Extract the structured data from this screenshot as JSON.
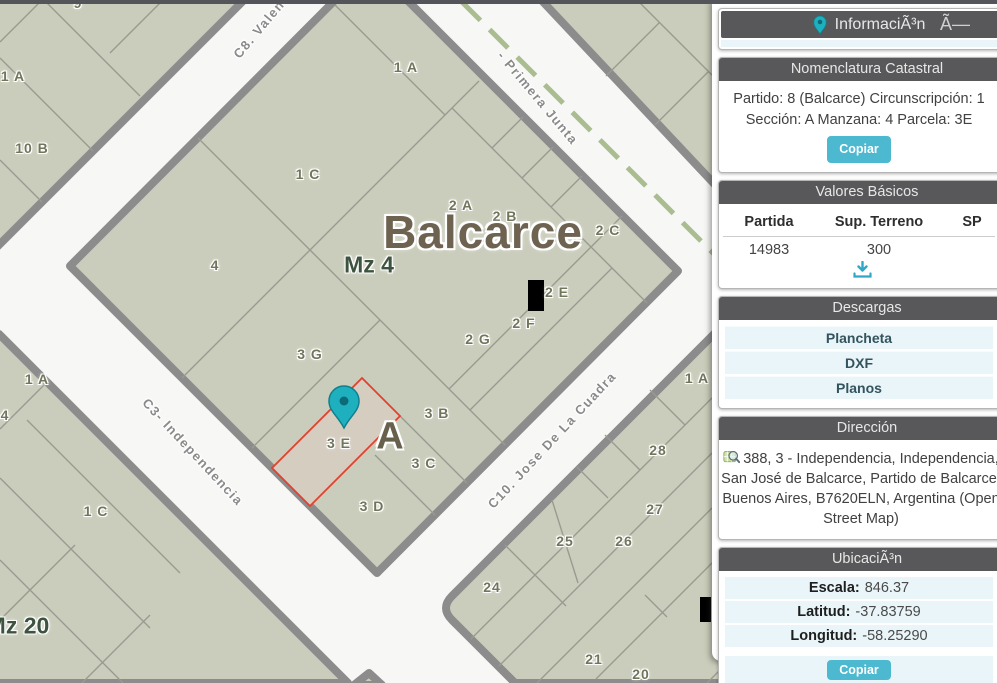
{
  "theme": {
    "accent": "#4cb9d0",
    "panelHeader": "#58585a",
    "rowBg": "#e9f5f8",
    "street": "#f7f7f5",
    "block": "#cacdbb",
    "blockBorder": "#8c8c8c",
    "selectedParcelStroke": "#e3402e",
    "selectedParcelFill": "#d6cdc1",
    "routeDash": "#a9bd90",
    "labelOlive": "#70765c",
    "labelGreen": "#3d5340",
    "labelBrown": "#6e6350",
    "markerTeal": "#1fb0c0"
  },
  "sidebar": {
    "info": {
      "title": "InformaciÃ³n",
      "close_label": "Ã—"
    },
    "nomenclatura": {
      "title": "Nomenclatura Catastral",
      "line1": "Partido: 8 (Balcarce) Circunscripción: 1",
      "line2": "Sección: A Manzana: 4 Parcela: 3E",
      "copy_label": "Copiar"
    },
    "valores": {
      "title": "Valores Básicos",
      "columns": [
        "Partida",
        "Sup. Terreno",
        "SP"
      ],
      "row": [
        "14983",
        "300",
        ""
      ]
    },
    "descargas": {
      "title": "Descargas",
      "items": [
        "Plancheta",
        "DXF",
        "Planos"
      ]
    },
    "direccion": {
      "title": "Dirección",
      "text": "388, 3 - Independencia, Independencia, San José de Balcarce, Partido de Balcarce, Buenos Aires, B7620ELN, Argentina (Open Street Map)"
    },
    "ubicacion": {
      "title": "UbicaciÃ³n",
      "rows": [
        {
          "label": "Escala:",
          "value": "846.37"
        },
        {
          "label": "Latitud:",
          "value": "-37.83759"
        },
        {
          "label": "Longitud:",
          "value": "-58.25290"
        }
      ],
      "copy_label": "Copiar"
    }
  },
  "map": {
    "labels": [
      {
        "t": "9",
        "x": 78,
        "y": 3,
        "c": "p"
      },
      {
        "t": "1 A",
        "x": 13,
        "y": 76,
        "c": "p"
      },
      {
        "t": "10 B",
        "x": 32,
        "y": 148,
        "c": "p"
      },
      {
        "t": "1 A",
        "x": 406,
        "y": 67,
        "c": "p"
      },
      {
        "t": "1 C",
        "x": 308,
        "y": 174,
        "c": "p"
      },
      {
        "t": "2 A",
        "x": 461,
        "y": 205,
        "c": "p"
      },
      {
        "t": "2 B",
        "x": 505,
        "y": 216,
        "c": "p"
      },
      {
        "t": "2 C",
        "x": 608,
        "y": 230,
        "c": "p"
      },
      {
        "t": "4",
        "x": 215,
        "y": 265,
        "c": "p"
      },
      {
        "t": "2 E",
        "x": 557,
        "y": 292,
        "c": "p"
      },
      {
        "t": "2 F",
        "x": 524,
        "y": 323,
        "c": "p"
      },
      {
        "t": "2 G",
        "x": 478,
        "y": 339,
        "c": "p"
      },
      {
        "t": "3 G",
        "x": 310,
        "y": 354,
        "c": "p"
      },
      {
        "t": "3 B",
        "x": 437,
        "y": 413,
        "c": "p"
      },
      {
        "t": "3 E",
        "x": 339,
        "y": 443,
        "c": "p"
      },
      {
        "t": "3 C",
        "x": 424,
        "y": 463,
        "c": "p"
      },
      {
        "t": "3 D",
        "x": 372,
        "y": 506,
        "c": "p"
      },
      {
        "t": "1 A",
        "x": 37,
        "y": 379,
        "c": "p"
      },
      {
        "t": "4",
        "x": 5,
        "y": 415,
        "c": "p"
      },
      {
        "t": "1 C",
        "x": 96,
        "y": 511,
        "c": "p"
      },
      {
        "t": "1 A",
        "x": 697,
        "y": 378,
        "c": "p"
      },
      {
        "t": "28",
        "x": 658,
        "y": 450,
        "c": "p"
      },
      {
        "t": "27",
        "x": 655,
        "y": 509,
        "c": "p"
      },
      {
        "t": "26",
        "x": 624,
        "y": 541,
        "c": "p"
      },
      {
        "t": "25",
        "x": 565,
        "y": 541,
        "c": "p"
      },
      {
        "t": "24",
        "x": 492,
        "y": 587,
        "c": "p"
      },
      {
        "t": "21",
        "x": 594,
        "y": 659,
        "c": "p"
      },
      {
        "t": "20",
        "x": 641,
        "y": 674,
        "c": "p"
      },
      {
        "t": "Balcarce",
        "x": 483,
        "y": 232,
        "c": "city"
      },
      {
        "t": "Mz 4",
        "x": 369,
        "y": 265,
        "c": "mz"
      },
      {
        "t": "Mz 20",
        "x": 18,
        "y": 626,
        "c": "mz"
      },
      {
        "t": "A",
        "x": 390,
        "y": 437,
        "c": "zone"
      },
      {
        "t": "C8. Valen",
        "x": 259,
        "y": 29,
        "c": "street",
        "r": -50
      },
      {
        "t": "- Primera Junta",
        "x": 538,
        "y": 98,
        "c": "street",
        "r": 50
      },
      {
        "t": "C3- Independencia",
        "x": 193,
        "y": 452,
        "c": "street",
        "r": 47
      },
      {
        "t": "C10. Jose De La Cuadra",
        "x": 552,
        "y": 440,
        "c": "street",
        "r": -47
      }
    ]
  }
}
